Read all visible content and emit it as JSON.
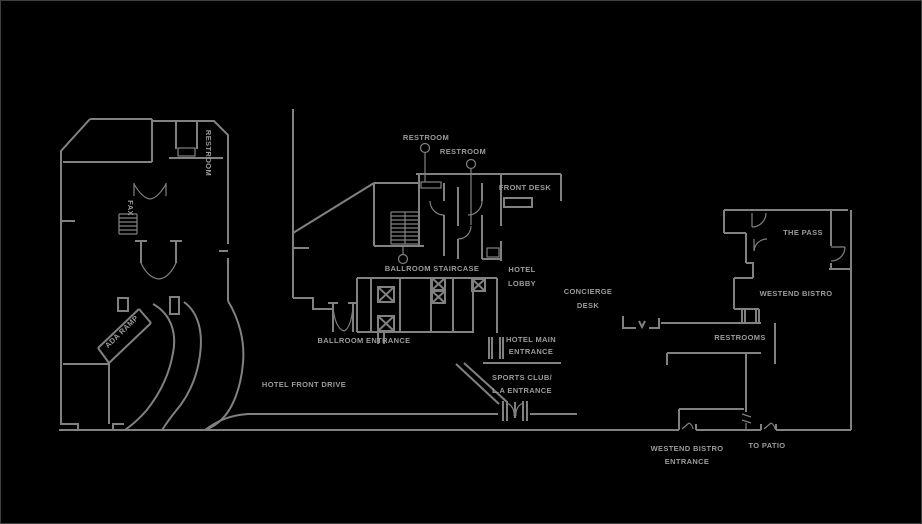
{
  "canvas": {
    "width": 922,
    "height": 524,
    "background": "#000000",
    "wall_color": "#818181",
    "text_color": "#9b9b9b"
  },
  "labels": {
    "left_restroom": "RESTROOM",
    "fax": "FAX",
    "ada_ramp": "ADA RAMP",
    "restroom_1": "RESTROOM",
    "restroom_2": "RESTROOM",
    "front_desk": "FRONT DESK",
    "ballroom_staircase": "BALLROOM STAIRCASE",
    "hotel_lobby_line1": "HOTEL",
    "hotel_lobby_line2": "LOBBY",
    "concierge_line1": "CONCIERGE",
    "concierge_line2": "DESK",
    "ballroom_entrance": "BALLROOM ENTRANCE",
    "hotel_main_line1": "HOTEL MAIN",
    "hotel_main_line2": "ENTRANCE",
    "sports_club_line1": "SPORTS CLUB/",
    "sports_club_line2": "L.A ENTRANCE",
    "hotel_front_drive": "HOTEL FRONT DRIVE",
    "the_pass": "THE PASS",
    "westend_bistro": "WESTEND BISTRO",
    "restrooms": "RESTROOMS",
    "westend_entrance_line1": "WESTEND BISTRO",
    "westend_entrance_line2": "ENTRANCE",
    "to_patio": "TO PATIO"
  }
}
